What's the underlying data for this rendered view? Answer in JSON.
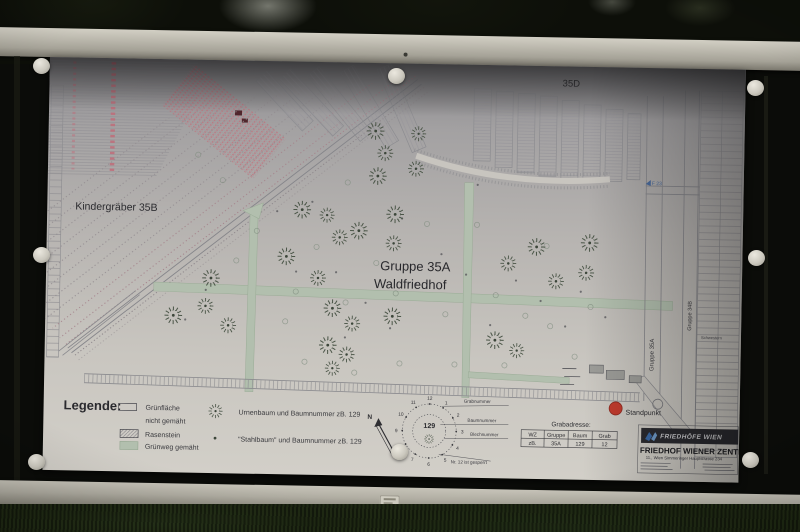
{
  "map": {
    "labels": {
      "area_top": "35D",
      "kindergraeber": "Kindergräber 35B",
      "group_line1": "Gruppe 35A",
      "group_line2": "Waldfriedhof",
      "vertical_road_left": "Gruppe 35A",
      "vertical_road_right": "Gruppe 34B",
      "blue_ref": "F 23",
      "schwestern": "Schwestern",
      "standpunkt": "Standpunkt",
      "compass": "N"
    },
    "legend": {
      "title": "Legende:",
      "items": [
        {
          "symbol": "rect-outline",
          "label_lines": [
            "Grünfläche",
            "nicht gemäht"
          ]
        },
        {
          "symbol": "rect-hatched",
          "label_lines": [
            "Rasenstein"
          ]
        },
        {
          "symbol": "rect-green",
          "label_lines": [
            "Grünweg gemäht"
          ]
        },
        {
          "symbol": "tree",
          "label_lines": [
            "Urnenbaum und Baumnummer zB. 129"
          ]
        },
        {
          "symbol": "dot",
          "label_lines": [
            "\"Stahlbaum\" und Baumnummer zB. 129"
          ]
        }
      ]
    },
    "tree_detail": {
      "center_number": "129",
      "clock_numbers": [
        "1",
        "2",
        "3",
        "4",
        "5",
        "6",
        "7",
        "8",
        "9",
        "10",
        "11",
        "12"
      ],
      "callouts": [
        "Grabnummer",
        "Baumnummer",
        "Blechnummer"
      ],
      "note": "Nr. 12 ist gesperrt"
    },
    "grab_table": {
      "title": "Grabadresse:",
      "headers": [
        "WZ",
        "Gruppe",
        "Baum",
        "Grab"
      ],
      "row": [
        "zB.",
        "35A",
        "129",
        "12"
      ]
    },
    "publisher": {
      "brand": "FRIEDHÖFE WIEN",
      "title": "FRIEDHOF WIENER ZENTRAL",
      "address": "11., Wien Simmeringer Hauptstrasse 234"
    },
    "colors": {
      "green_path": "#b2bfae",
      "standpunkt_red": "#c23b2e",
      "pink_rows": "#c46a76",
      "logo_blue": "#3a6aa8"
    },
    "trees": [
      [
        327,
        68,
        1
      ],
      [
        337,
        90,
        0.9
      ],
      [
        370,
        70,
        0.85
      ],
      [
        330,
        113,
        1
      ],
      [
        368,
        105,
        0.9
      ],
      [
        255,
        148,
        1
      ],
      [
        280,
        153,
        0.85
      ],
      [
        312,
        168,
        1
      ],
      [
        293,
        175,
        0.9
      ],
      [
        348,
        151,
        1
      ],
      [
        347,
        180,
        0.9
      ],
      [
        240,
        195,
        1
      ],
      [
        272,
        216,
        0.9
      ],
      [
        165,
        218,
        1
      ],
      [
        160,
        246,
        0.9
      ],
      [
        128,
        256,
        1
      ],
      [
        183,
        265,
        0.9
      ],
      [
        287,
        246,
        1
      ],
      [
        307,
        261,
        0.9
      ],
      [
        283,
        283,
        1
      ],
      [
        302,
        292,
        0.9
      ],
      [
        288,
        306,
        0.85
      ],
      [
        347,
        253,
        1
      ],
      [
        462,
        198,
        0.9
      ],
      [
        490,
        181,
        1
      ],
      [
        510,
        215,
        0.9
      ],
      [
        543,
        176,
        1
      ],
      [
        540,
        206,
        0.9
      ],
      [
        450,
        275,
        1
      ],
      [
        472,
        285,
        0.85
      ]
    ],
    "ring_marks": [
      [
        150,
        95
      ],
      [
        175,
        120
      ],
      [
        210,
        170
      ],
      [
        250,
        230
      ],
      [
        300,
        240
      ],
      [
        350,
        230
      ],
      [
        260,
        300
      ],
      [
        310,
        310
      ],
      [
        355,
        300
      ],
      [
        400,
        250
      ],
      [
        430,
        160
      ],
      [
        450,
        230
      ],
      [
        480,
        250
      ],
      [
        505,
        260
      ],
      [
        530,
        290
      ],
      [
        410,
        300
      ],
      [
        380,
        160
      ],
      [
        300,
        120
      ],
      [
        270,
        185
      ],
      [
        330,
        200
      ],
      [
        460,
        300
      ],
      [
        500,
        180
      ],
      [
        545,
        240
      ],
      [
        240,
        260
      ],
      [
        190,
        200
      ]
    ],
    "dot_marks": [
      [
        230,
        150
      ],
      [
        265,
        140
      ],
      [
        290,
        210
      ],
      [
        320,
        240
      ],
      [
        345,
        265
      ],
      [
        370,
        220
      ],
      [
        395,
        190
      ],
      [
        420,
        210
      ],
      [
        445,
        260
      ],
      [
        470,
        215
      ],
      [
        495,
        235
      ],
      [
        520,
        260
      ],
      [
        300,
        275
      ],
      [
        250,
        210
      ],
      [
        355,
        155
      ],
      [
        430,
        120
      ],
      [
        535,
        225
      ],
      [
        560,
        250
      ],
      [
        160,
        230
      ],
      [
        140,
        260
      ]
    ]
  }
}
